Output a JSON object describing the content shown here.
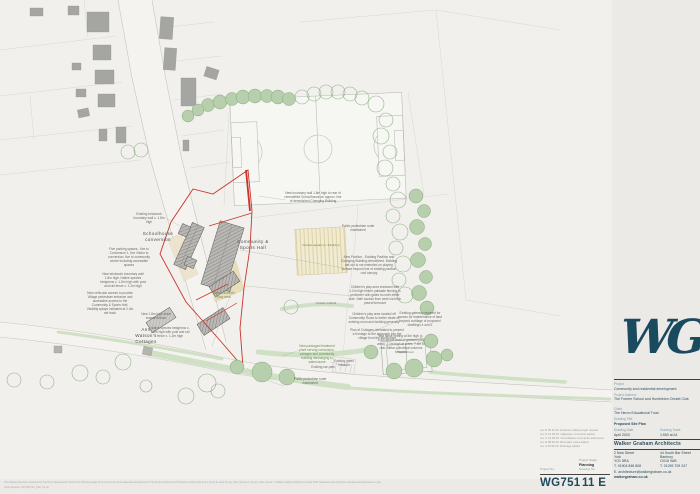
{
  "plan": {
    "labels": {
      "schoolhouse": "Schoolhouse conversion",
      "community": "Community & Sports Hall",
      "ann_watsons": "Ann Watson's Cottages",
      "cricket_square": "Cricket square (c. 23x23m)",
      "cricket_outfield": "Cricket outfield",
      "sports_court": "Sports Court"
    },
    "annotations": [
      "Existing brickwork boundary wall c. 1.8m high",
      "Five parking spaces - five to Conversion 1, five Visitor to conversion, five to community centre including accessible spaces",
      "New brickwork boundary wall 1.8m high. Native species hedgerow c. 1.8m high with post and rail fence c. 1.2m high",
      "New vehicular access to provide Village pedestrian entrance and accessible access to the Community & Sports Hall. Visibility splays indicated at 2.4m set back",
      "New boundary wall 1.8m high to rear of remodelled Schoolhouse on approx. line of demolished Changing Building",
      "Public pedestrian route maintained",
      "New Pavilion - Existing Pavilion and Changing Building demolished. Building set-out is not extended on playing surface beyond line of existing pavilion roof canopy",
      "Children's play area enclosed with 1.2m high timber palisade fencing to perimeter with gates to north either side. Safe access from west via brick paved forecourt",
      "Children's play area located off Community Room to better relate to existing room and building generally",
      "Plan of Cottages orientated to present a frontage to the approach into the village from the south-east",
      "Existing gateway retained for access for maintenance of land beyond curtilage of proposed dwellings 4 and 5",
      "Ball strike netting at 5m high (c. 4.5m above level of grassed play area). 2.1m high at sides, 7.4m to rear. Metal cylindrical columns between",
      "New packaged treatment plant serving conversion, cottages and community building discharging to watercourse",
      "Existing gates retained",
      "Existing car park",
      "Public pedestrian route maintained",
      "New 1.8m high close boarded fence",
      "Native species hedgerow c. 1.8m high with post and rail fence c. 1.2m high",
      "New Children's play area"
    ]
  },
  "titleblock": {
    "logo": "WG",
    "project_label": "Project",
    "project": "Community and residential development",
    "address_label": "Project Address",
    "address": "The Former School and Humbleton Cricket Club",
    "client_label": "Client",
    "client": "The Heron Educational Trust",
    "drawing_title_label": "Drawing Title",
    "drawing_title": "Proposed Site Plan",
    "date_label": "Drawing Date",
    "date": "April 2020",
    "scale_label": "Drawing Scale",
    "scale": "1:500 at A1",
    "firm": "Walker Graham Architects",
    "office1": [
      "2 New Street",
      "York",
      "YO1 8RA",
      "T. 01904 848 808"
    ],
    "office2": [
      "44 South Bar Street",
      "Banbury",
      "OX16 9AB",
      "T. 01295 709 247"
    ],
    "email": "E. architecture@walkergraham.co.uk",
    "website": "walkergraham.co.uk"
  },
  "numberblock": {
    "revisions": [
      "rev. E 29.10.20. Entrance railing length revised",
      "rev. D 21.09.20. Highways comments added",
      "rev. C 21.09.20. Consultation comments addressed",
      "rev. B 08.06.20. Boundary notes added",
      "rev. A 05.06.20. Drainage added"
    ],
    "project_no_label": "Project No.",
    "project_no": "WG751",
    "stage_label": "Project Stage",
    "stage": "Planning",
    "drawing_no_label": "Drawing No.",
    "drawing_no": "11 E"
  },
  "footer": {
    "line1": "This drawing has been produced for The Heron Educational Trust for the Planning stage of the Community and residential development at The Former School and Humbleton Cricket Club and is not to be used for any other purpose or by any other person. © Walker Graham Architects Limited 2020. Measurements should be checked and guaranteed on site.",
    "line2": "Origin filename: WG751(011)_Plan_A1.pln"
  }
}
